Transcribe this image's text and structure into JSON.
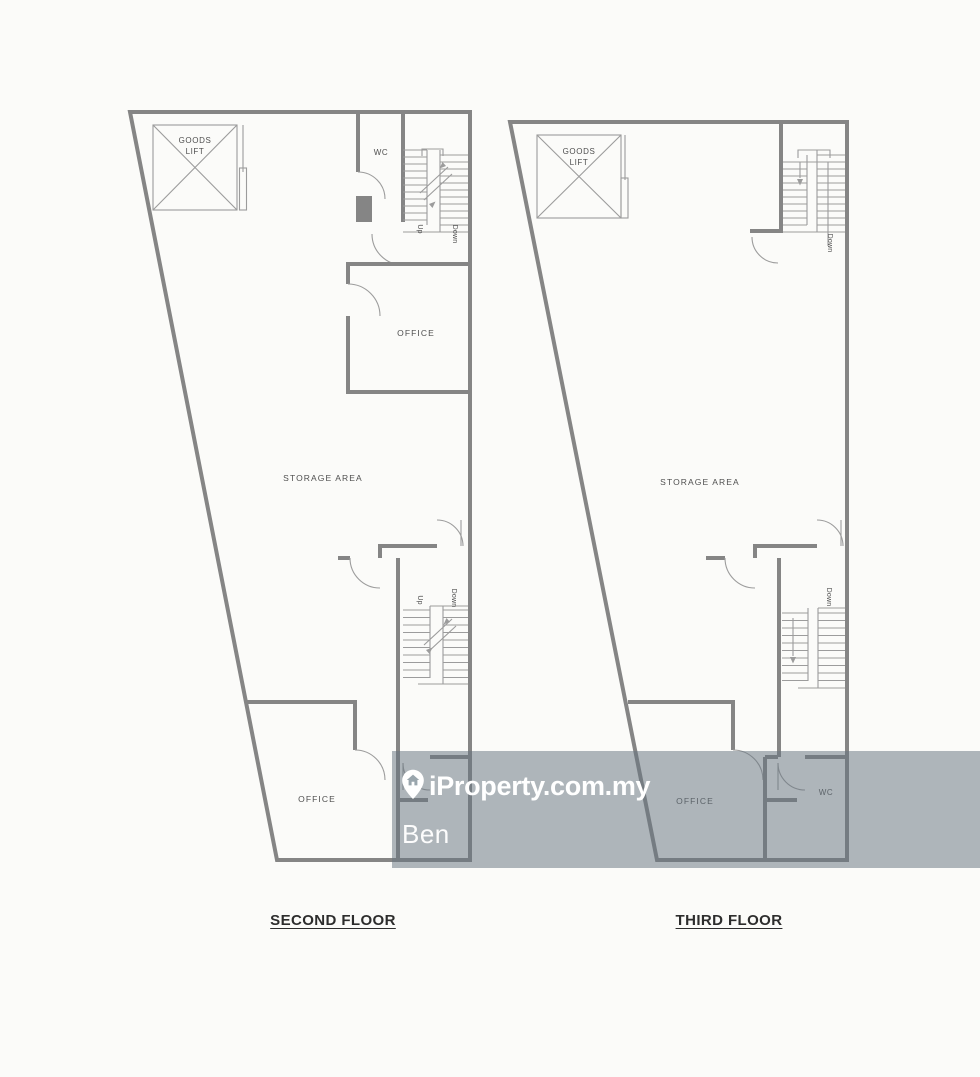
{
  "page": {
    "type": "scanned floor plan photo"
  },
  "colors": {
    "paper": "#fbfbf9",
    "wall": "#858585",
    "thin_line": "#9c9c9c",
    "label_text": "#4f4f4f",
    "title_text": "#2d2d2d",
    "watermark_band": "rgba(104,117,128,0.52)",
    "watermark_text": "#ffffff"
  },
  "watermark": {
    "brand": "iProperty.com.my",
    "agent_name": "Ben",
    "pin_icon": "location-pin-house-icon"
  },
  "floors": [
    {
      "title": "SECOND FLOOR",
      "labels": {
        "goods_lift_line1": "GOODS",
        "goods_lift_line2": "LIFT",
        "wc": "WC",
        "office_middle": "OFFICE",
        "storage": "STORAGE AREA",
        "office_bottom": "OFFICE",
        "stairs_top_up": "Up",
        "stairs_top_down": "Down",
        "stairs_middle_up": "Up",
        "stairs_middle_down": "Down"
      }
    },
    {
      "title": "THIRD FLOOR",
      "labels": {
        "goods_lift_line1": "GOODS",
        "goods_lift_line2": "LIFT",
        "storage": "STORAGE AREA",
        "office_bottom": "OFFICE",
        "wc": "WC",
        "stairs_top_down": "Down",
        "stairs_middle_down": "Down"
      }
    }
  ]
}
